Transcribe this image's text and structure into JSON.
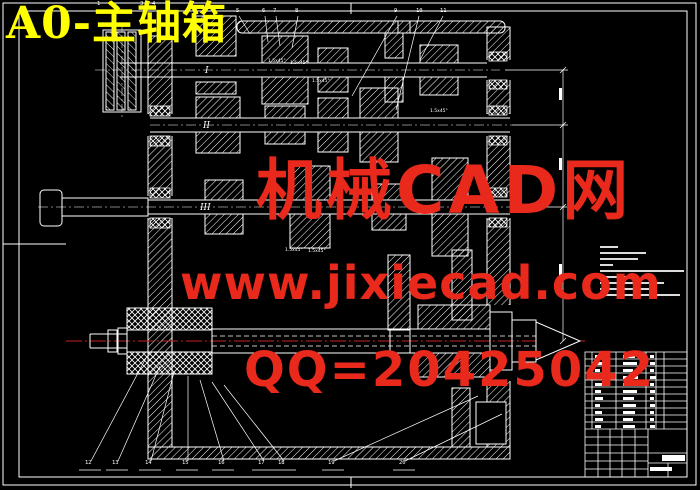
{
  "title": {
    "text": "A0-主轴箱"
  },
  "watermark": {
    "line1": "机械CAD网",
    "line2": "www.jixiecad.com",
    "line3": "QQ=20425042",
    "color": "#e8291b"
  },
  "drawing": {
    "shaft_labels": {
      "s1": "I",
      "s2": "II",
      "s3": "III"
    },
    "chamfer_text": "1.5x45°"
  },
  "callouts": {
    "top": [
      {
        "n": "1",
        "x": 97,
        "y": 2
      },
      {
        "n": "2",
        "x": 109,
        "y": 2
      },
      {
        "n": "3",
        "x": 140,
        "y": 2
      },
      {
        "n": "4",
        "x": 152,
        "y": 2
      },
      {
        "n": "5",
        "x": 236,
        "y": 9
      },
      {
        "n": "6",
        "x": 262,
        "y": 9
      },
      {
        "n": "7",
        "x": 273,
        "y": 9
      },
      {
        "n": "8",
        "x": 295,
        "y": 9
      },
      {
        "n": "9",
        "x": 394,
        "y": 9
      },
      {
        "n": "10",
        "x": 416,
        "y": 9
      },
      {
        "n": "11",
        "x": 440,
        "y": 9
      }
    ],
    "bottom": [
      {
        "n": "12",
        "x": 85,
        "y": 461
      },
      {
        "n": "13",
        "x": 112,
        "y": 461
      },
      {
        "n": "14",
        "x": 145,
        "y": 461
      },
      {
        "n": "15",
        "x": 182,
        "y": 461
      },
      {
        "n": "16",
        "x": 218,
        "y": 461
      },
      {
        "n": "17",
        "x": 258,
        "y": 461
      },
      {
        "n": "18",
        "x": 278,
        "y": 461
      },
      {
        "n": "19",
        "x": 328,
        "y": 461
      },
      {
        "n": "20",
        "x": 399,
        "y": 461
      }
    ]
  },
  "notes": {
    "line_widths": [
      18,
      46,
      38,
      13,
      84,
      30,
      64,
      54,
      80
    ]
  },
  "bom": {
    "top": 353,
    "cols": [
      595,
      623,
      650
    ],
    "rows": [
      [
        6,
        12,
        4
      ],
      [
        8,
        14,
        5
      ],
      [
        5,
        10,
        4
      ],
      [
        9,
        15,
        6
      ],
      [
        7,
        12,
        4
      ],
      [
        6,
        14,
        5
      ],
      [
        8,
        11,
        4
      ],
      [
        5,
        13,
        5
      ],
      [
        7,
        12,
        4
      ],
      [
        8,
        10,
        4
      ],
      [
        6,
        12,
        5
      ]
    ]
  },
  "colors": {
    "background": "#000000",
    "line": "#ffffff",
    "title_yellow": "#ffff00",
    "watermark_red": "#e8291b",
    "centerline_red": "#c31f1f"
  }
}
